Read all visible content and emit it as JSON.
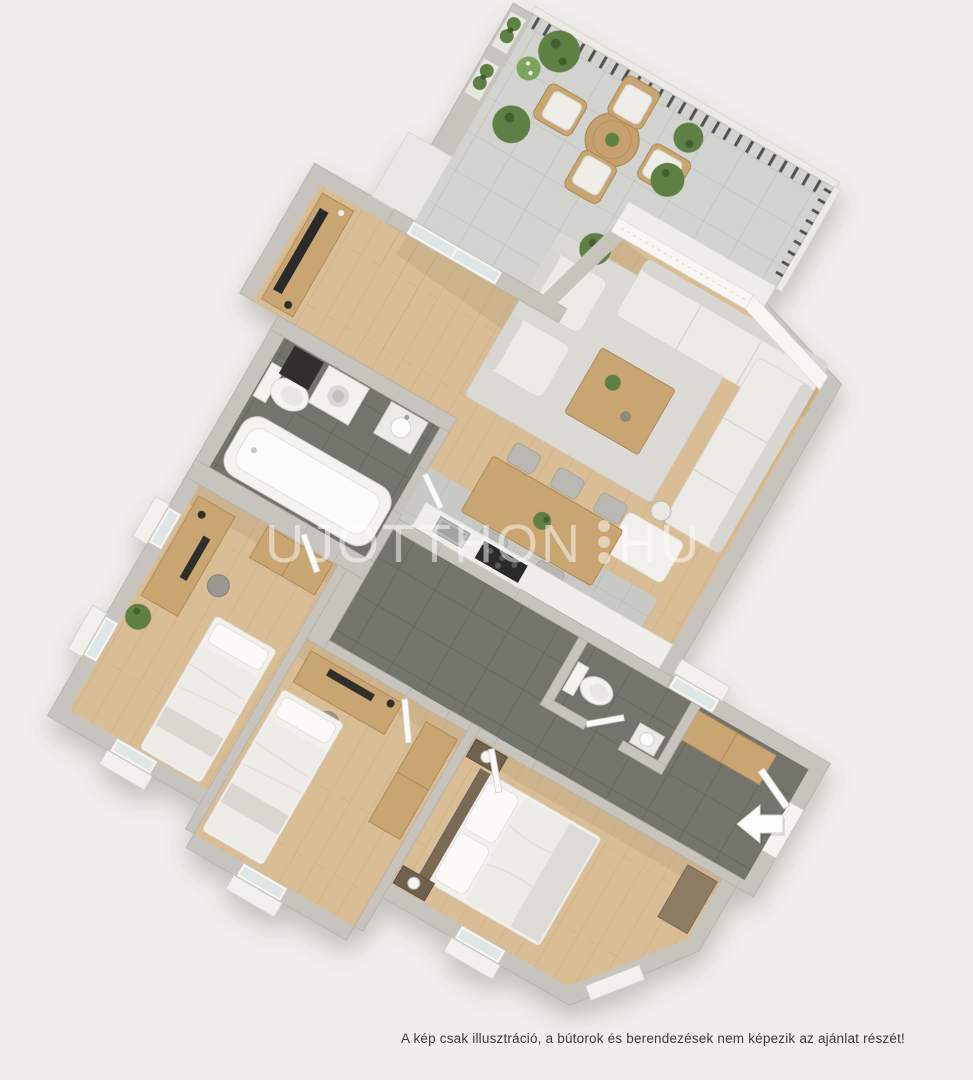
{
  "watermark": {
    "brand": "UJOTTHON",
    "tld": "HU",
    "separator": "three-vertical-dots"
  },
  "caption": "A kép csak illusztráció, a bútorok és berendezések nem képezik az ajánlat részét!",
  "palette": {
    "background": "#efeeea",
    "wall": "#c7c4be",
    "wood_floor": "#d9bd94",
    "dark_tile": "#73746c",
    "terrace_tile": "#d2d3cf",
    "kitchen_tile": "#c8c9c4",
    "furniture_wood": "#c8a571",
    "fabric": "#eceae5",
    "plant_green": "#5f8044"
  },
  "rooms": [
    "terrace",
    "living-room-with-kitchen",
    "bathroom",
    "bedroom-1",
    "bedroom-2",
    "master-bedroom",
    "hallway",
    "wc"
  ]
}
